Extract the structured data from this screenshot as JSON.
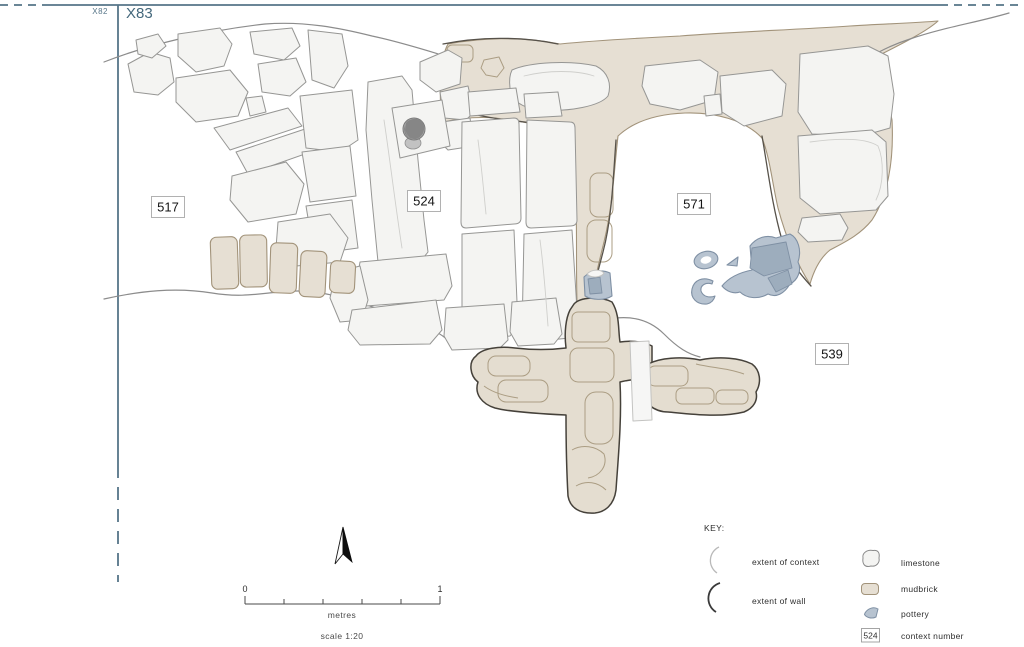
{
  "title": "archaeological context plan X83",
  "grid": {
    "x82_label": "X82",
    "x83_label": "X83",
    "line_color": "#567588"
  },
  "contexts": [
    {
      "id": "517",
      "x": 168,
      "y": 207
    },
    {
      "id": "524",
      "x": 424,
      "y": 201
    },
    {
      "id": "571",
      "x": 694,
      "y": 204
    },
    {
      "id": "539",
      "x": 832,
      "y": 354
    }
  ],
  "key": {
    "title": "KEY:",
    "items_left": [
      {
        "symbol": "extent-of-context-arc",
        "label": "extent of context"
      },
      {
        "symbol": "extent-of-wall-arc",
        "label": "extent of wall"
      }
    ],
    "items_right": [
      {
        "symbol": "limestone-swatch",
        "label": "limestone"
      },
      {
        "symbol": "mudbrick-swatch",
        "label": "mudbrick"
      },
      {
        "symbol": "pottery-swatch",
        "label": "pottery"
      },
      {
        "symbol": "context-number-box",
        "label": "context number",
        "box_text": "524"
      }
    ]
  },
  "scale_bar": {
    "start_label": "0",
    "end_label": "1",
    "unit_label": "metres",
    "scale_label": "scale 1:20"
  },
  "north_arrow": {
    "name": "north-arrow"
  },
  "colors": {
    "grid_line": "#567588",
    "limestone_fill": "#f4f4f2",
    "limestone_stroke": "#969694",
    "mudbrick_fill": "#e6dfd3",
    "mudbrick_stroke": "#a2937a",
    "mudbrick_dark_outline": "#45413a",
    "pottery_fill": "#b7c3d0",
    "pottery_stroke": "#7f90a4",
    "contour_line": "#8c8c8c",
    "label_text": "#141414"
  }
}
